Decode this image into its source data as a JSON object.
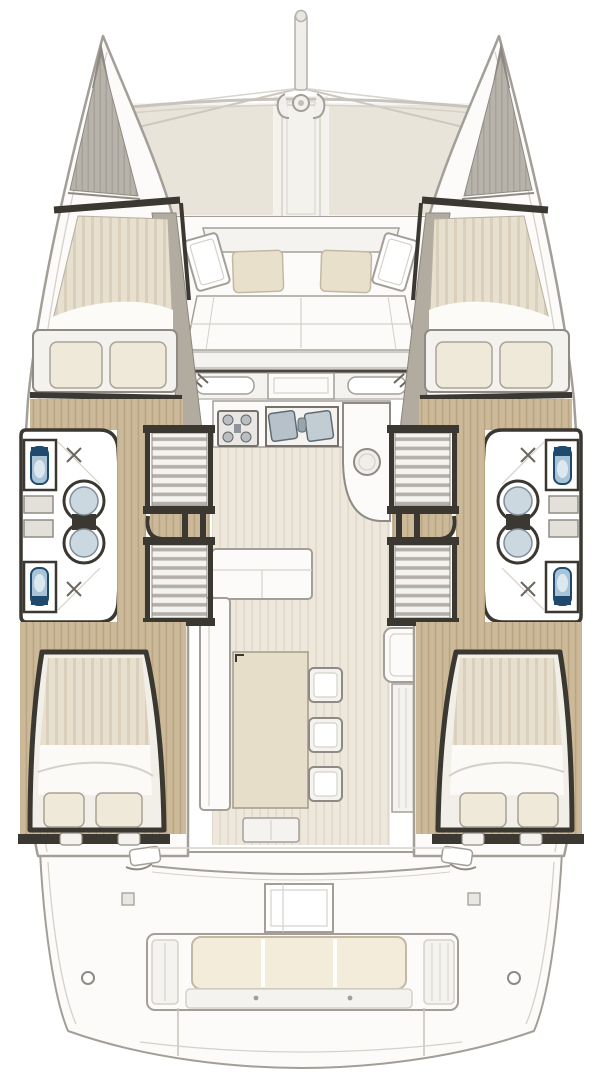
{
  "diagram": {
    "kind": "boat-floor-plan",
    "view": "top-down",
    "vessel_type": "sailing-catamaran",
    "symmetry": "port-starboard-mirrored",
    "areas": [
      {
        "id": "bowsprit",
        "label": "bowsprit with forestay lines"
      },
      {
        "id": "trampoline",
        "label": "foredeck trampoline, two netting panels with center walkway"
      },
      {
        "id": "forward-cockpit",
        "label": "forward cockpit bench with two loose cushions and angled side tables"
      },
      {
        "id": "forward-cabin-port",
        "label": "port forward double berth with two pillows"
      },
      {
        "id": "forward-cabin-starboard",
        "label": "starboard forward double berth with two pillows"
      },
      {
        "id": "head-port-forward",
        "label": "port forward bathroom: toilet, round basin, shower drain"
      },
      {
        "id": "head-port-aft",
        "label": "port aft bathroom: toilet, round basin, shower drain"
      },
      {
        "id": "head-starboard-forward",
        "label": "starboard forward bathroom: toilet, round basin, shower drain"
      },
      {
        "id": "head-starboard-aft",
        "label": "starboard aft bathroom: toilet, round basin, shower drain"
      },
      {
        "id": "companionway-stairs",
        "label": "two stair flights down into each hull"
      },
      {
        "id": "galley",
        "label": "galley with stove top and twin sink"
      },
      {
        "id": "galley-counter",
        "label": "rounded worktop with round basin"
      },
      {
        "id": "saloon",
        "label": "saloon with L-shaped sofa, rectangular table and three stools"
      },
      {
        "id": "aft-cabin-port",
        "label": "port aft double berth with two pillows"
      },
      {
        "id": "aft-cabin-starboard",
        "label": "starboard aft double berth with two pillows"
      },
      {
        "id": "aft-cockpit",
        "label": "aft cockpit with table and transom bench"
      },
      {
        "id": "transom-bench",
        "label": "stern bench with three-section cushion"
      },
      {
        "id": "swim-platform",
        "label": "swim platform between the hulls"
      }
    ]
  },
  "colors": {
    "white": "#ffffff",
    "hullFill": "#fcfbf9",
    "offwhite": "#f4f3ef",
    "line": "#a39f98",
    "lightLine": "#d5d1ca",
    "dark": "#3b3731",
    "inkSoft": "#6b675f",
    "wood": "#cbb999",
    "woodStripe": "#b9a581",
    "mattress": "#e7e0cf",
    "mattressStripe": "#d9cfba",
    "floor": "#eee8dc",
    "floorStripe": "#e0d9ca",
    "tramp": "#e9e4d9",
    "trampSeam": "#f6f4ef",
    "cushion": "#e8e0cb",
    "cushionEdge": "#c2b9a5",
    "cream": "#f3ecda",
    "tableTop": "#e6dec8",
    "steel": "#b4b0a9",
    "steelDark": "#8f959a",
    "anchorGray": "#b7b2aa",
    "anchorStripe": "#a5a098",
    "wall": "#b2aba0",
    "toiletBlue": "#a9c4d6",
    "toiletDark": "#1f4a6e",
    "sinkBlue": "#ccd8df",
    "sinkRim": "#7e8d97"
  }
}
